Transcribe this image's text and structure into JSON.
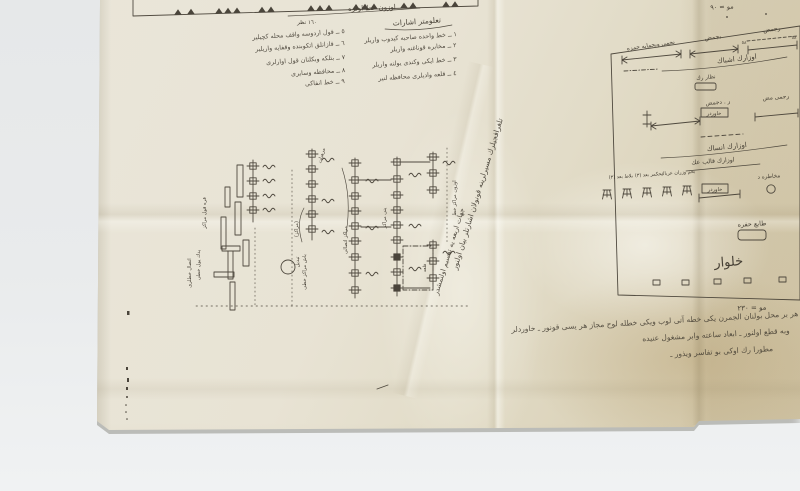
{
  "photo": {
    "background_color": "#e9ebec",
    "paper_color": "#e6e1d0",
    "ink_color": "#3e382e"
  },
  "top_diagram": {
    "title": "اوزون خط اولره",
    "tick_label": "١٦٠ نظر"
  },
  "legend": {
    "header": "تعلومتر اشارات",
    "right_column": [
      "١ ــ خط واحده صاحبه كيدوب واريلر",
      "٢ ــ مخابره قوناغنه واريلر",
      "٣ ــ خط ايكى وكندى يولنه واريلر",
      "٤ ــ قلعه واديلرى محافظه لنير"
    ],
    "left_column": [
      "٥ ــ قول اردوسه واقف محله كچيلير",
      "٦ ــ قازانلق اتكوبنده وقفايه واريلير",
      "٧ ــ بتلكه وبكلنان قول اوارلرى",
      "٨ ــ محافظه وسايرى",
      "٩ ــ خط انفاكى"
    ]
  },
  "center_title": {
    "line1": "تلغرافجيلرك مسيرلرينه قونولان اشارتلر بيان اولنور",
    "line2": "جهات اربعه يه تقسيم اولنمشدر"
  },
  "central_diagram": {
    "labels": [
      "قره قول مراكز",
      "يدك يول خطى",
      "اتصال خطلرى",
      "(مراكز)",
      "باش مراكز خطى",
      "مراكز اتصالى",
      "اوزون مراكز خط",
      "مرهبات",
      "تبديل",
      "قلعه",
      "ينى مراكز"
    ]
  },
  "right_panel": {
    "scale_top": "مو = ٩٠",
    "scale_bottom": "مو = ٢٣٠",
    "row1": {
      "left_label": "نجمى وبحمايه حمزه",
      "mid_label": "بجمض",
      "right_label": "رجمض",
      "dash_num": "٥٨",
      "annotation": "اوزارك اشباك",
      "small_label": "نظار رك"
    },
    "row2": {
      "right_label": "رجمى مض",
      "mid_label": "ر . دجمض",
      "boxed_label": "خاوردر",
      "annotation": "اوزارك انساك",
      "annotation2": "اوزارك قالب عك"
    },
    "row3": {
      "label_1": "بلاط بعد (٣)",
      "label_2": "بحكمر بعد (٣)",
      "label_3": "بحم وزران عرباك",
      "boxed_label": "خاوردر",
      "right_label": "مخاطره د"
    },
    "lower": {
      "stamp_label": "طابع حفره",
      "big_label": "خلوار"
    }
  },
  "bottom_note": {
    "lines": [
      "هر بر محل بولنان الجمرن يكى خطه آتى لوب ويكى خطله لوح مجاز هر يسى قونور ـ خاوردلر",
      "وبه قطع اولنور ـ ابعاد ساعته وابر مشغول عنيده",
      "مطورا رك اوكى بو تفاسر ويذور ـ"
    ]
  }
}
